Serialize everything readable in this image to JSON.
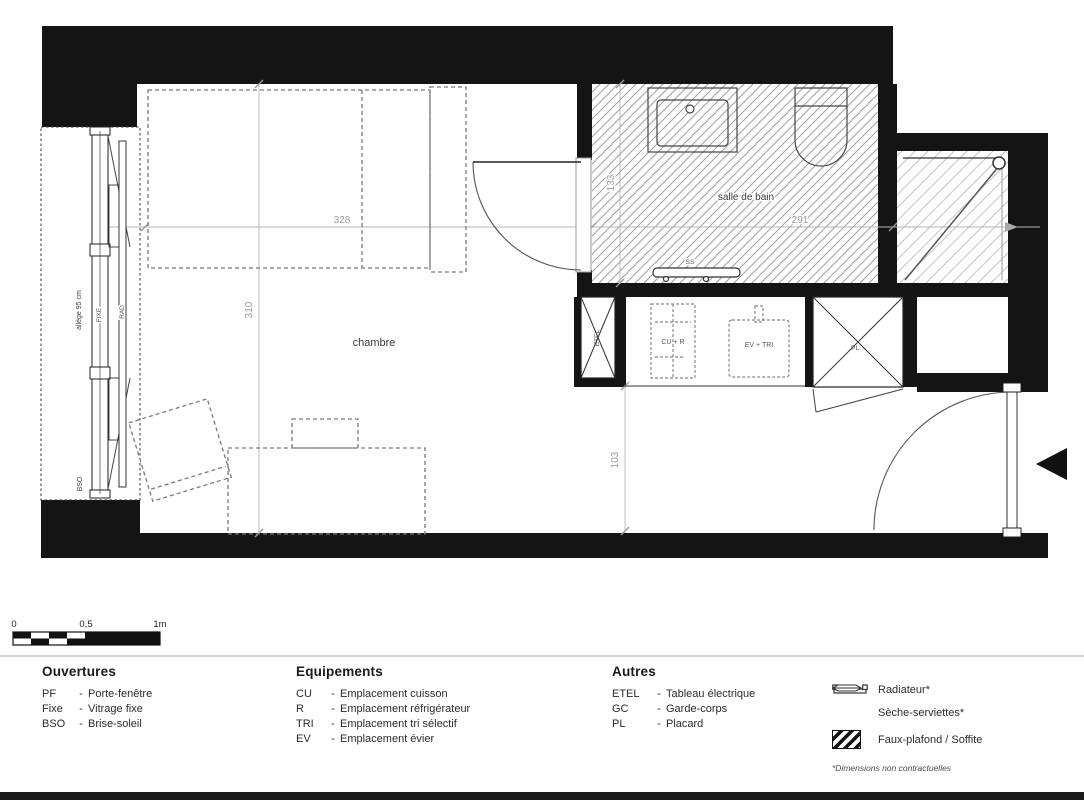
{
  "plan": {
    "room_labels": {
      "chambre": "chambre",
      "salle_de_bain": "salle de bain"
    },
    "dimensions": {
      "chambre_width": "328",
      "chambre_depth": "310",
      "sdb_width": "291",
      "sdb_depth": "133",
      "entree_depth": "103"
    },
    "window_labels": {
      "allege": "allège 95 cm",
      "bso": "BSO",
      "fixe": "FIXE",
      "rad": "RAD"
    },
    "equipment_labels": {
      "etel": "ETEL",
      "cu_r": "CU + R",
      "ev_tri": "EV + TRI",
      "pl": "PL.",
      "ss": "SS"
    }
  },
  "scale_bar": {
    "tick_0": "0",
    "tick_05": "0,5",
    "tick_1": "1m"
  },
  "legend": {
    "dash": "-",
    "ouvertures": {
      "title": "Ouvertures",
      "items": [
        {
          "abbr": "PF",
          "label": "Porte-fenêtre"
        },
        {
          "abbr": "Fixe",
          "label": "Vitrage fixe"
        },
        {
          "abbr": "BSO",
          "label": "Brise-soleil"
        }
      ]
    },
    "equipements": {
      "title": "Equipements",
      "items": [
        {
          "abbr": "CU",
          "label": "Emplacement cuisson"
        },
        {
          "abbr": "R",
          "label": "Emplacement réfrigérateur"
        },
        {
          "abbr": "TRI",
          "label": "Emplacement tri sélectif"
        },
        {
          "abbr": "EV",
          "label": "Emplacement évier"
        }
      ]
    },
    "autres": {
      "title": "Autres",
      "items": [
        {
          "abbr": "ETEL",
          "label": "Tableau électrique"
        },
        {
          "abbr": "GC",
          "label": "Garde-corps"
        },
        {
          "abbr": "PL",
          "label": "Placard"
        }
      ]
    },
    "symbols": [
      {
        "name": "radiateur",
        "label": "Radiateur*"
      },
      {
        "name": "seche-serviettes",
        "label": "Sèche-serviettes*"
      },
      {
        "name": "faux-plafond",
        "label": "Faux-plafond / Soffite"
      }
    ],
    "footnote": "*Dimensions non contractuelles"
  },
  "colors": {
    "wall": "#141414",
    "hatch": "#9f9f9f",
    "hatch_light": "#c4c4c4",
    "dim_line": "#b5b5b5",
    "dashed_furniture": "#7a7a7a"
  }
}
